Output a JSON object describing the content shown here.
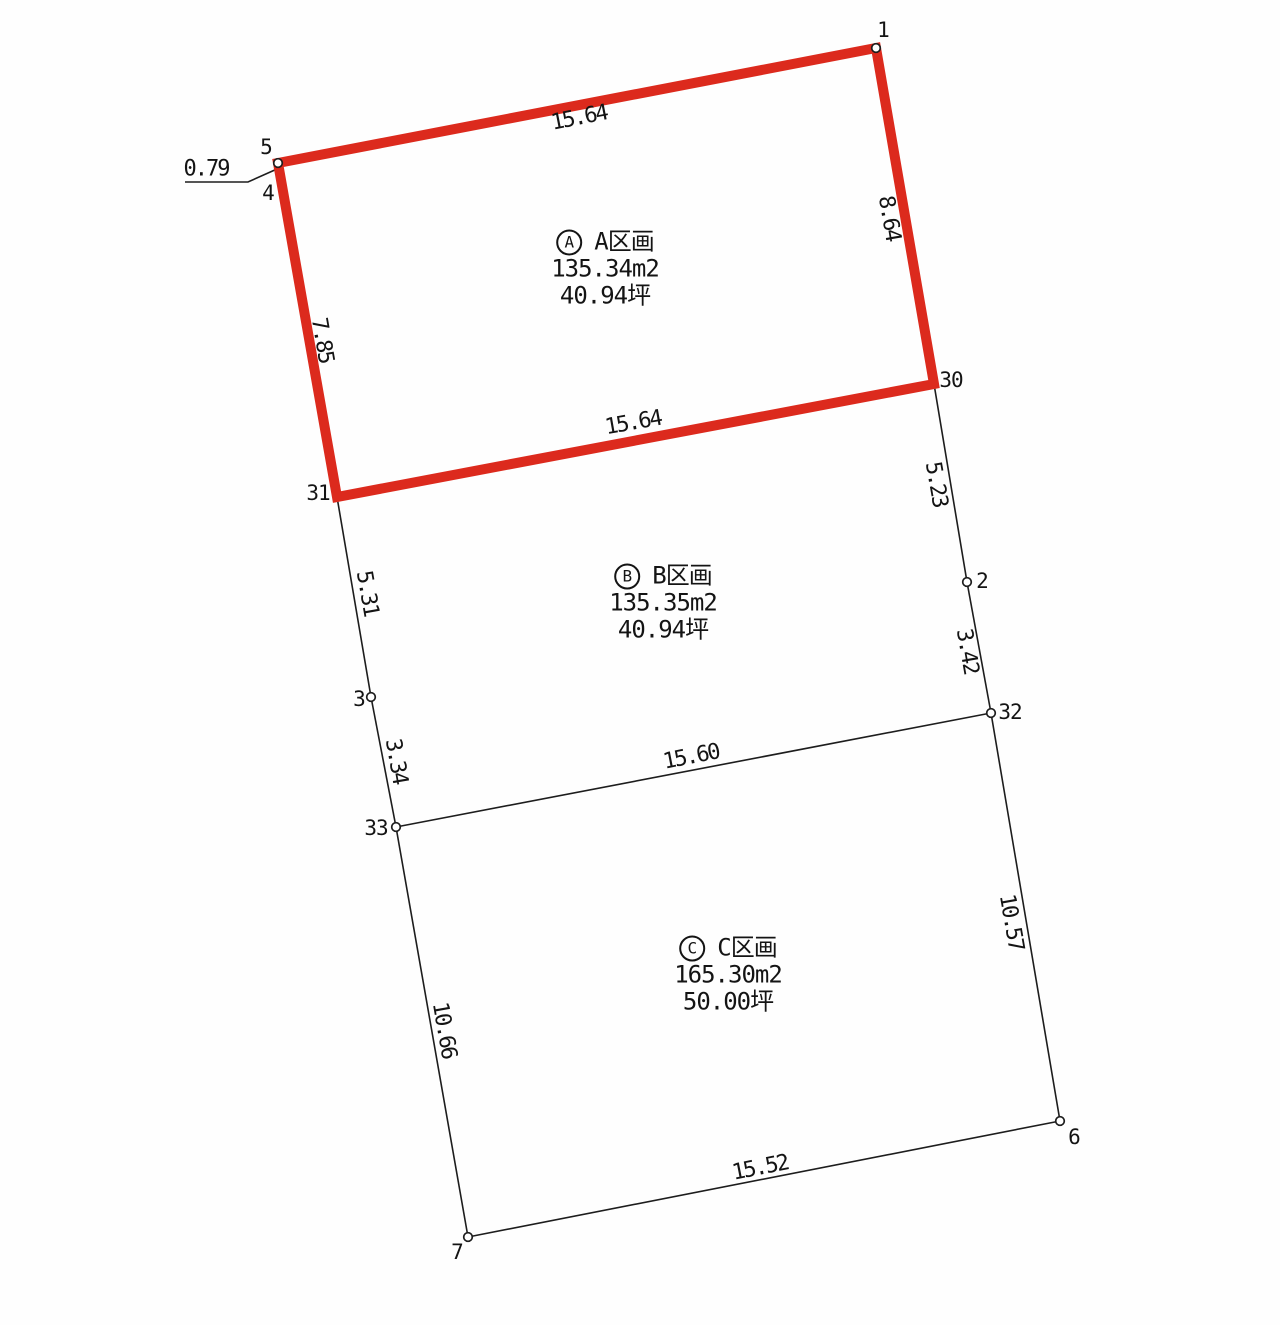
{
  "colors": {
    "parcel_a_outline": "#dc2a1d",
    "boundary_line": "#1d1d1d",
    "text": "#141414",
    "background": "#fefefe"
  },
  "diagram": {
    "points": [
      {
        "id": "1",
        "x": 876,
        "y": 48,
        "lx": 883,
        "ly": 30,
        "marker": true
      },
      {
        "id": "5",
        "x": 278,
        "y": 163,
        "lx": 266,
        "ly": 147,
        "marker": true
      },
      {
        "id": "4",
        "x": 281,
        "y": 179,
        "lx": 268,
        "ly": 193,
        "marker": false
      },
      {
        "id": "30",
        "x": 934,
        "y": 384,
        "lx": 951,
        "ly": 380,
        "marker": false
      },
      {
        "id": "31",
        "x": 337,
        "y": 497,
        "lx": 318,
        "ly": 493,
        "marker": false
      },
      {
        "id": "2",
        "x": 967,
        "y": 582,
        "lx": 982,
        "ly": 581,
        "marker": true
      },
      {
        "id": "3",
        "x": 371,
        "y": 697,
        "lx": 359,
        "ly": 699,
        "marker": true
      },
      {
        "id": "32",
        "x": 991,
        "y": 713,
        "lx": 1010,
        "ly": 712,
        "marker": true
      },
      {
        "id": "33",
        "x": 396,
        "y": 827,
        "lx": 376,
        "ly": 828,
        "marker": true
      },
      {
        "id": "6",
        "x": 1060,
        "y": 1121,
        "lx": 1074,
        "ly": 1137,
        "marker": true
      },
      {
        "id": "7",
        "x": 468,
        "y": 1237,
        "lx": 457,
        "ly": 1252,
        "marker": true
      }
    ],
    "red_parcel_outline": [
      "5",
      "1",
      "30",
      "31"
    ],
    "black_edges": [
      [
        "30",
        "2"
      ],
      [
        "2",
        "32"
      ],
      [
        "32",
        "6"
      ],
      [
        "31",
        "3"
      ],
      [
        "3",
        "33"
      ],
      [
        "33",
        "7"
      ],
      [
        "33",
        "32"
      ],
      [
        "7",
        "6"
      ]
    ],
    "leader": {
      "points": "185,182 248,182 277,169"
    },
    "measurements": [
      {
        "text": "0.79",
        "x": 206,
        "y": 169,
        "rotate": 0
      },
      {
        "text": "15.64",
        "x": 579,
        "y": 118,
        "rotate": -11
      },
      {
        "text": "8.64",
        "x": 889,
        "y": 218,
        "rotate": 80
      },
      {
        "text": "7.85",
        "x": 322,
        "y": 340,
        "rotate": 80
      },
      {
        "text": "15.64",
        "x": 633,
        "y": 423,
        "rotate": -10
      },
      {
        "text": "5.23",
        "x": 936,
        "y": 484,
        "rotate": 80
      },
      {
        "text": "5.31",
        "x": 367,
        "y": 593,
        "rotate": 80
      },
      {
        "text": "3.42",
        "x": 967,
        "y": 651,
        "rotate": 80
      },
      {
        "text": "3.34",
        "x": 396,
        "y": 761,
        "rotate": 80
      },
      {
        "text": "15.60",
        "x": 691,
        "y": 757,
        "rotate": -11
      },
      {
        "text": "10.57",
        "x": 1011,
        "y": 922,
        "rotate": 80
      },
      {
        "text": "10.66",
        "x": 444,
        "y": 1030,
        "rotate": 80
      },
      {
        "text": "15.52",
        "x": 760,
        "y": 1168,
        "rotate": -11
      }
    ],
    "parcels": [
      {
        "badge": "A",
        "name": "A区画",
        "area_m2": "135.34m2",
        "area_tsubo": "40.94坪",
        "cx": 605,
        "cy": 269
      },
      {
        "badge": "B",
        "name": "B区画",
        "area_m2": "135.35m2",
        "area_tsubo": "40.94坪",
        "cx": 663,
        "cy": 603
      },
      {
        "badge": "C",
        "name": "C区画",
        "area_m2": "165.30m2",
        "area_tsubo": "50.00坪",
        "cx": 728,
        "cy": 975
      }
    ]
  }
}
